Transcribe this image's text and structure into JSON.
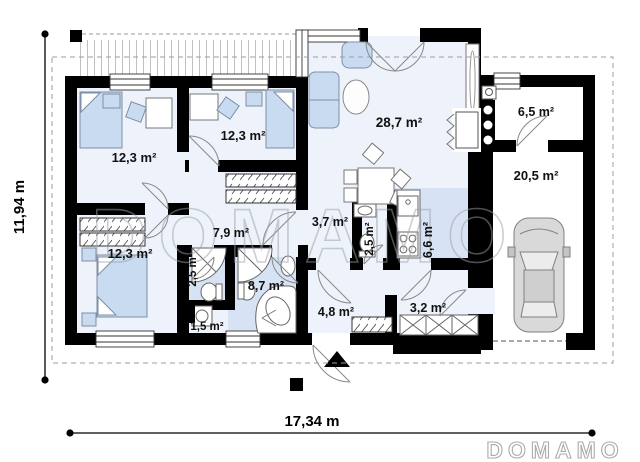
{
  "plan": {
    "type": "single-storey house floor plan",
    "watermark_center": "DOMAMO",
    "watermark_corner": "DOMAMO",
    "dim_height": "11,94 m",
    "dim_width": "17,34 m",
    "rooms": [
      {
        "id": "bedroom-top-left",
        "label": "12,3 m²"
      },
      {
        "id": "bedroom-top-middle",
        "label": "12,3 m²"
      },
      {
        "id": "living-room",
        "label": "28,7 m²"
      },
      {
        "id": "boiler-room",
        "label": "6,5 m²"
      },
      {
        "id": "garage",
        "label": "20,5 m²"
      },
      {
        "id": "bedroom-bottom-left",
        "label": "12,3 m²"
      },
      {
        "id": "corridor",
        "label": "7,9 m²"
      },
      {
        "id": "shower-room",
        "label": "2,5 m²"
      },
      {
        "id": "bathroom",
        "label": "8,7 m²"
      },
      {
        "id": "wc",
        "label": "1,5 m²"
      },
      {
        "id": "hall",
        "label": "3,7 m²"
      },
      {
        "id": "toilet",
        "label": "2,5 m²"
      },
      {
        "id": "kitchen",
        "label": "6,6 m²"
      },
      {
        "id": "entry",
        "label": "4,8 m²"
      },
      {
        "id": "vestibule",
        "label": "3,2 m²"
      }
    ],
    "colors": {
      "wall": "#000000",
      "floor": "#eef3fb",
      "wet_floor": "#d7e3f4",
      "furniture": "#c9dbf0",
      "watermark": "#a9a9a9"
    }
  }
}
